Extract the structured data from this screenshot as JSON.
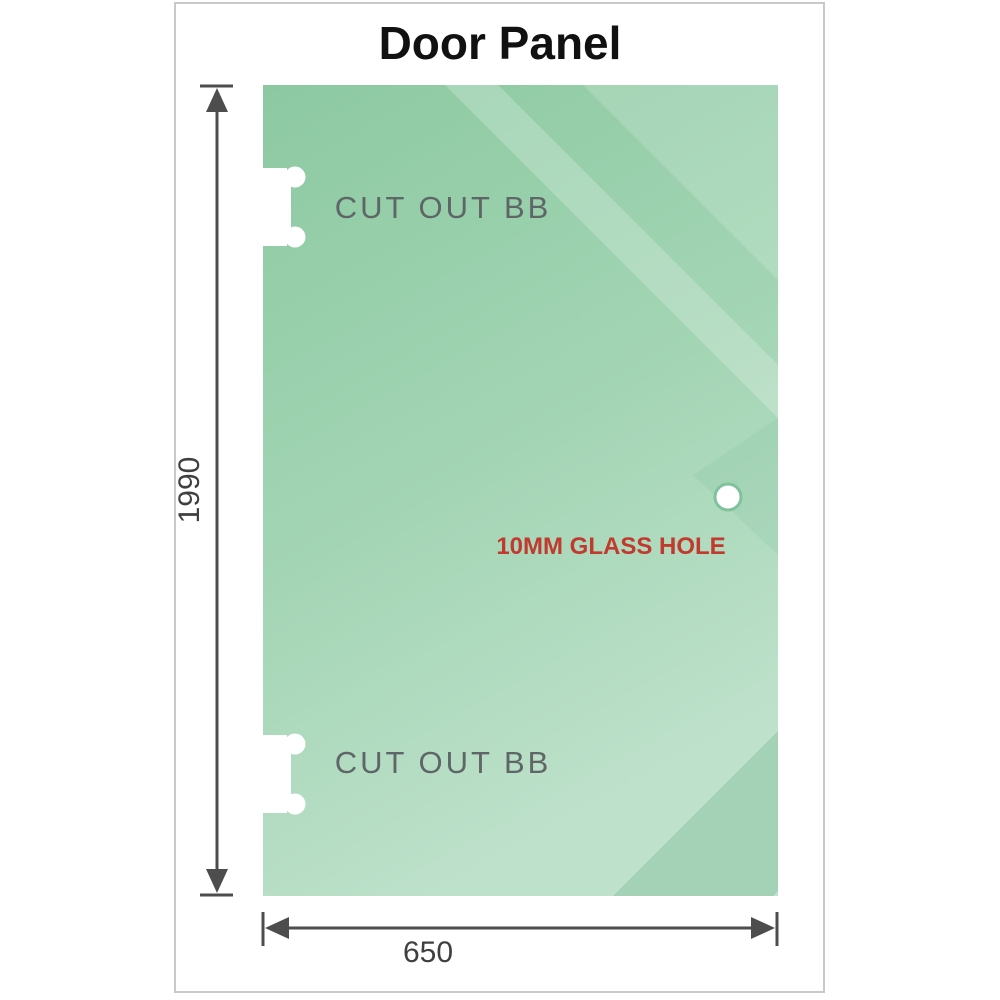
{
  "title": "Door Panel",
  "panel": {
    "cutout_top_label": "CUT OUT BB",
    "cutout_bottom_label": "CUT OUT BB",
    "hole_label": "10MM GLASS HOLE",
    "glass_color_dark": "#8cc9a2",
    "glass_color_light": "#bee1cb",
    "hole_label_color": "#c2392e",
    "cutout_label_color": "#5f6667"
  },
  "dimensions": {
    "height_value": "1990",
    "width_value": "650",
    "line_color": "#4d4d4d"
  }
}
